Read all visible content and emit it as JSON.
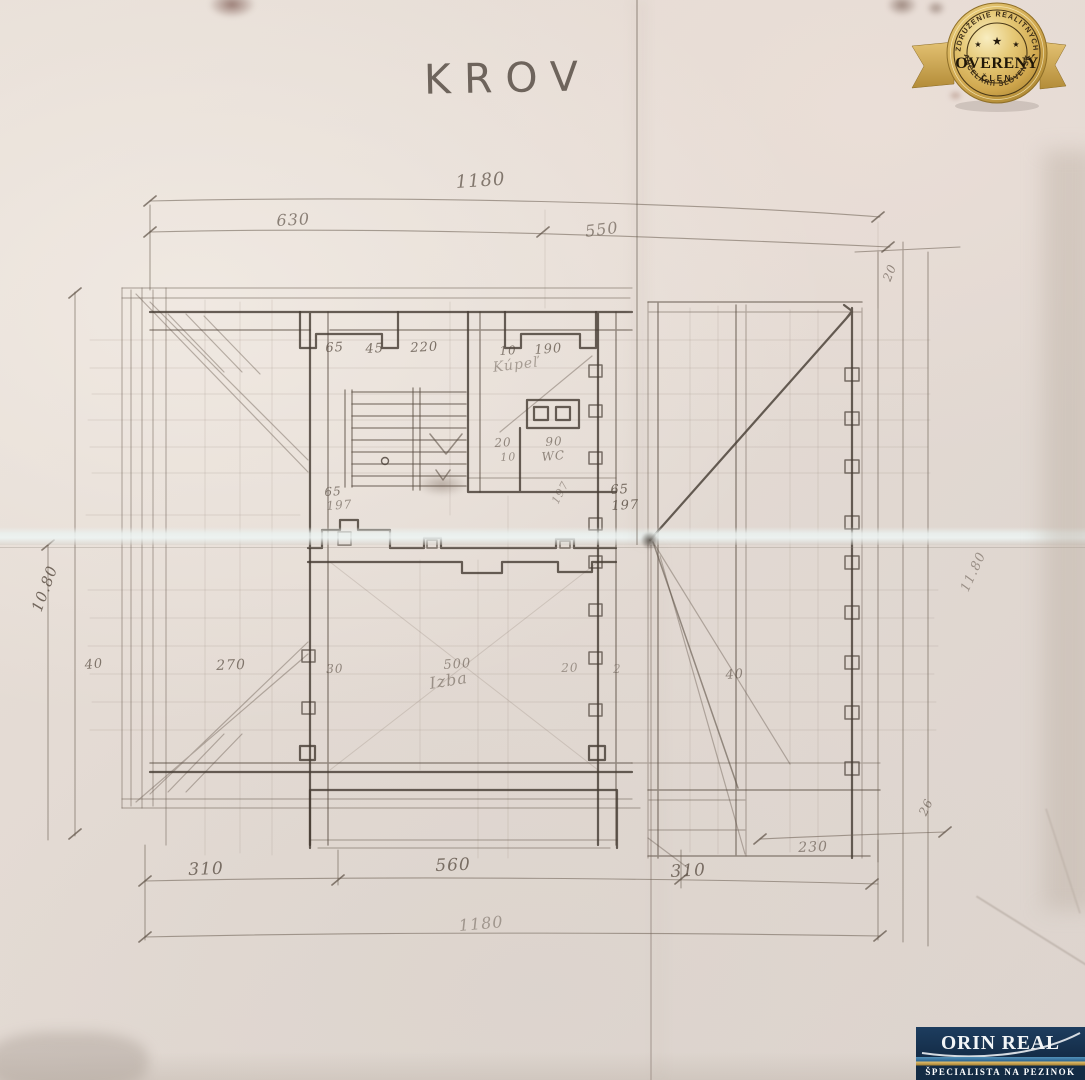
{
  "title": "KROV",
  "colors": {
    "paper": "#e4dbd4",
    "pencil": "#564a3f",
    "badge_gold": "#d9b85e",
    "logo_navy": "#17334f",
    "logo_gold": "#c9a44a"
  },
  "plan": {
    "labels": [
      {
        "text": "1180",
        "x": 455,
        "y": 172,
        "rot": -4,
        "fs": 18,
        "op": 0.7
      },
      {
        "text": "630",
        "x": 276,
        "y": 211,
        "rot": -3,
        "fs": 16,
        "op": 0.65
      },
      {
        "text": "550",
        "x": 584,
        "y": 222,
        "rot": -7,
        "fs": 16,
        "op": 0.6
      },
      {
        "text": "65",
        "x": 325,
        "y": 341,
        "rot": -3,
        "fs": 13,
        "op": 0.75
      },
      {
        "text": "45",
        "x": 365,
        "y": 342,
        "rot": -3,
        "fs": 13,
        "op": 0.75
      },
      {
        "text": "220",
        "x": 410,
        "y": 341,
        "rot": -3,
        "fs": 13,
        "op": 0.75
      },
      {
        "text": "10",
        "x": 499,
        "y": 344,
        "rot": -3,
        "fs": 12,
        "op": 0.7
      },
      {
        "text": "190",
        "x": 534,
        "y": 343,
        "rot": -4,
        "fs": 13,
        "op": 0.7
      },
      {
        "text": "Kúpeľ",
        "x": 492,
        "y": 360,
        "rot": -7,
        "fs": 14,
        "op": 0.45
      },
      {
        "text": "20",
        "x": 494,
        "y": 436,
        "rot": -3,
        "fs": 12,
        "op": 0.6
      },
      {
        "text": "10",
        "x": 500,
        "y": 451,
        "rot": -3,
        "fs": 11,
        "op": 0.55
      },
      {
        "text": "90",
        "x": 545,
        "y": 435,
        "rot": -3,
        "fs": 12,
        "op": 0.6
      },
      {
        "text": "WC",
        "x": 541,
        "y": 450,
        "rot": -5,
        "fs": 12,
        "op": 0.6
      },
      {
        "text": "65",
        "x": 324,
        "y": 485,
        "rot": -3,
        "fs": 12,
        "op": 0.7
      },
      {
        "text": "197",
        "x": 326,
        "y": 499,
        "rot": -4,
        "fs": 12,
        "op": 0.55
      },
      {
        "text": "197",
        "x": 549,
        "y": 500,
        "rot": -62,
        "fs": 11,
        "op": 0.45
      },
      {
        "text": "65",
        "x": 610,
        "y": 483,
        "rot": -3,
        "fs": 13,
        "op": 0.8
      },
      {
        "text": "197",
        "x": 611,
        "y": 499,
        "rot": -3,
        "fs": 13,
        "op": 0.8
      },
      {
        "text": "10.80",
        "x": 28,
        "y": 608,
        "rot": -70,
        "fs": 15,
        "op": 0.8
      },
      {
        "text": "40",
        "x": 84,
        "y": 658,
        "rot": -5,
        "fs": 13,
        "op": 0.7
      },
      {
        "text": "270",
        "x": 216,
        "y": 658,
        "rot": -2,
        "fs": 14,
        "op": 0.7
      },
      {
        "text": "30",
        "x": 326,
        "y": 662,
        "rot": -2,
        "fs": 12,
        "op": 0.6
      },
      {
        "text": "500",
        "x": 443,
        "y": 658,
        "rot": -4,
        "fs": 13,
        "op": 0.55
      },
      {
        "text": "Izba",
        "x": 428,
        "y": 674,
        "rot": -9,
        "fs": 16,
        "op": 0.5
      },
      {
        "text": "20",
        "x": 561,
        "y": 661,
        "rot": -2,
        "fs": 12,
        "op": 0.5
      },
      {
        "text": "2",
        "x": 613,
        "y": 662,
        "rot": 0,
        "fs": 12,
        "op": 0.4
      },
      {
        "text": "40",
        "x": 725,
        "y": 668,
        "rot": -4,
        "fs": 13,
        "op": 0.6
      },
      {
        "text": "20",
        "x": 880,
        "y": 278,
        "rot": -68,
        "fs": 12,
        "op": 0.6
      },
      {
        "text": "11.80",
        "x": 958,
        "y": 588,
        "rot": -65,
        "fs": 13,
        "op": 0.5
      },
      {
        "text": "310",
        "x": 188,
        "y": 860,
        "rot": -2,
        "fs": 17,
        "op": 0.75
      },
      {
        "text": "560",
        "x": 435,
        "y": 856,
        "rot": -2,
        "fs": 17,
        "op": 0.75
      },
      {
        "text": "310",
        "x": 670,
        "y": 862,
        "rot": -3,
        "fs": 17,
        "op": 0.75
      },
      {
        "text": "1180",
        "x": 458,
        "y": 916,
        "rot": -5,
        "fs": 16,
        "op": 0.45
      },
      {
        "text": "230",
        "x": 798,
        "y": 840,
        "rot": -2,
        "fs": 14,
        "op": 0.6
      },
      {
        "text": "26",
        "x": 916,
        "y": 812,
        "rot": -65,
        "fs": 12,
        "op": 0.6
      }
    ]
  },
  "badge": {
    "arc_top": "ZDRUŽENIE REALITNÝCH",
    "arc_bottom": "KANCELÁRIÍ SLOVENSKA",
    "title": "OVERENÝ",
    "subtitle": "ČLEN",
    "star": "★"
  },
  "logo": {
    "name": "ORIN REAL",
    "tagline": "ŠPECIALISTA NA PEZINOK"
  }
}
